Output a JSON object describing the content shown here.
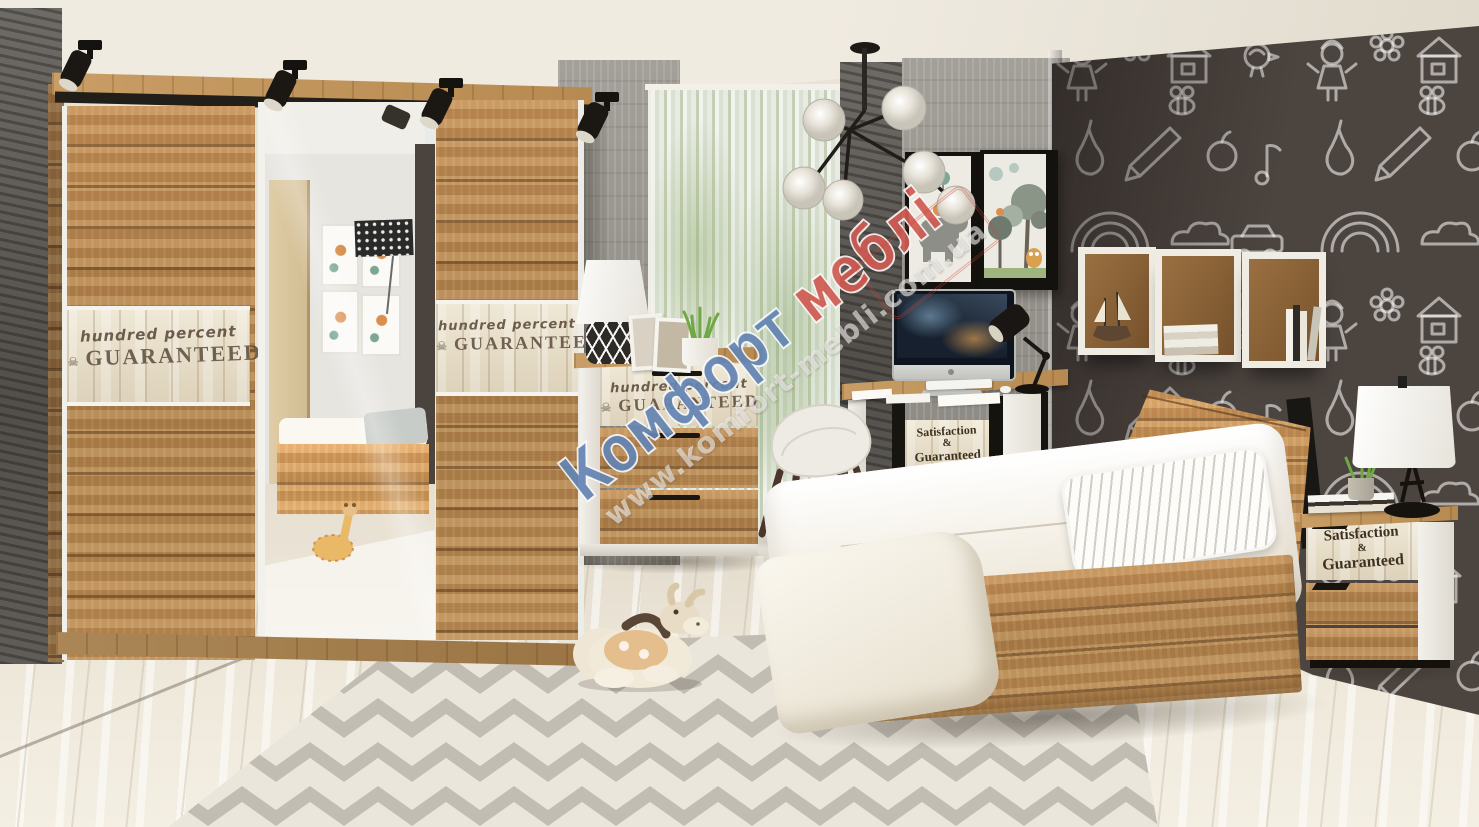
{
  "scene": {
    "type": "furniture-showroom-photo",
    "description": "Children's bedroom set in wotan oak and white: sliding-door mirrored wardrobe, chest of drawers, desk with computer and chair, single bed, nightstand with lamp, cube wall shelves, chalkboard doodle wall, chevron rug and plush toys.",
    "brand_watermark": "Комфорт меблі"
  },
  "watermark": {
    "word1": "Комфорт",
    "word2": "меблі",
    "url": "www.komfort-mebli.com.ua",
    "word1_color": "#4f74a8",
    "word2_color": "#c8463c"
  },
  "stamps": {
    "hundred": {
      "line1": "hundred percent",
      "line2": "GUARANTEED",
      "skull": "☠"
    },
    "satisfaction": {
      "line1": "Satisfaction",
      "line2": "&",
      "line3": "Guaranteed"
    }
  },
  "palette": {
    "wood": "#b9854e",
    "wood_dark": "#855a2e",
    "furniture_white": "#f2f0ea",
    "chalkboard": "#4c443f",
    "concrete": "#a09d96",
    "floor": "#eae4d7",
    "rug_white": "#f3efe7",
    "rug_gray": "#c7c3ba",
    "accent_black": "#17140f",
    "ceiling": "#efeadf"
  }
}
